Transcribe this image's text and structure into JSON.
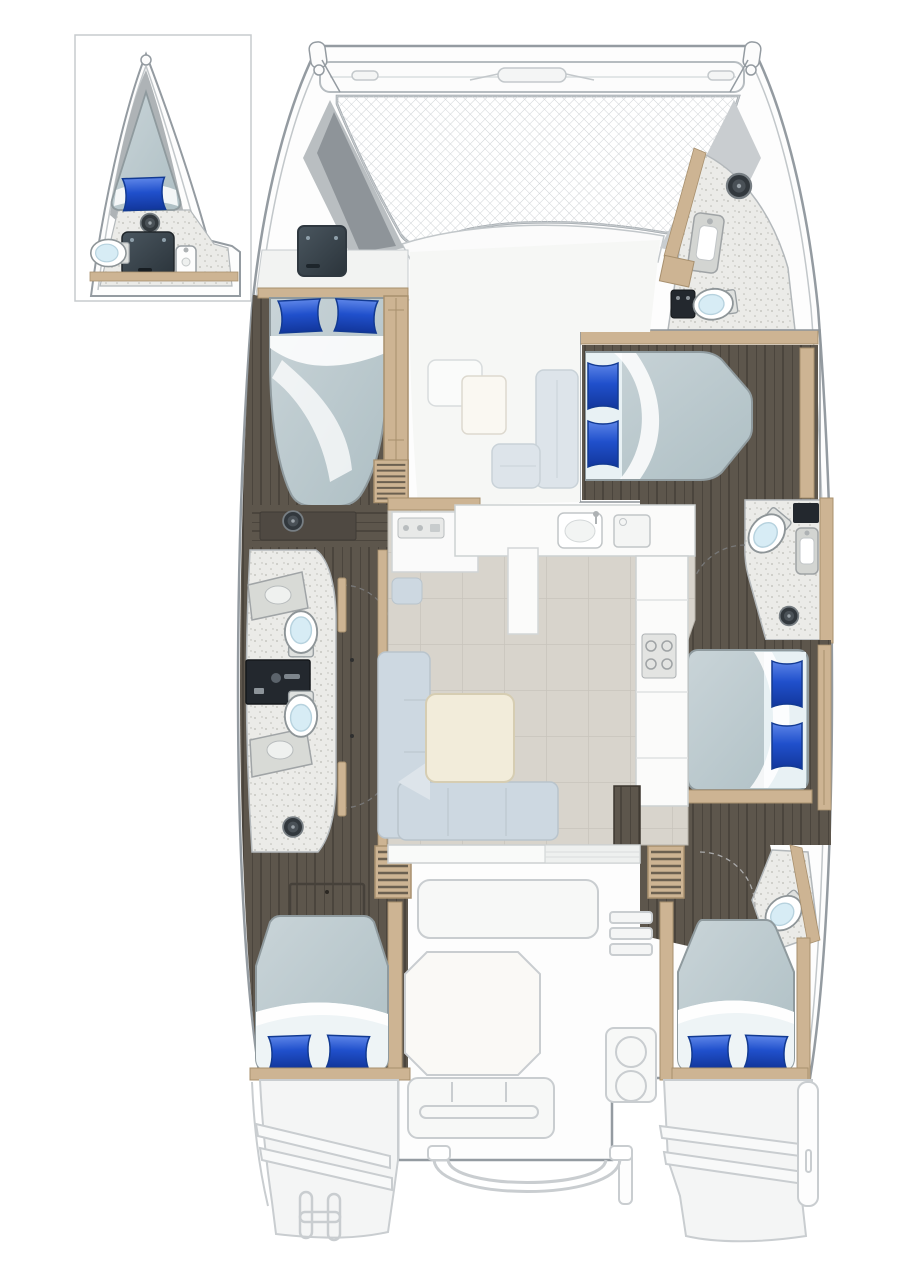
{
  "diagram": {
    "kind": "yacht-floor-plan",
    "vessel": "sailing catamaran — top-down accommodation deck plan",
    "inset_detail": {
      "location": "top-left",
      "depicts": [
        "forepeak crew berth",
        "blue pillow",
        "marine toilet",
        "wash basin",
        "deck hatch"
      ]
    },
    "port_hull": [
      "bow deck hatch",
      "forward double cabin with two blue pillows",
      "wardrobe",
      "steps",
      "bathroom with two toilets, two basins and dark vanity",
      "shower drains",
      "aft double cabin with two blue pillows",
      "companionway steps",
      "transom steps",
      "swim platform with boarding handle"
    ],
    "starboard_hull": [
      "bow head with basin and toilet",
      "deck hatch",
      "forward double berth with two blue pillows",
      "mid head with toilet, basin and shower",
      "mid double cabin with two blue pillows",
      "aft head with toilet",
      "aft double cabin with two blue pillows",
      "companionway steps",
      "transom steps",
      "swim platform with davit fitting"
    ],
    "bridgedeck": [
      "forward crossbeam",
      "trampoline net",
      "foredeck band",
      "forward lounge seats and table",
      "chart table with instrument panel",
      "galley counters with twin sinks",
      "stove with burners",
      "support column",
      "L-shaped saloon sofa",
      "square saloon table",
      "aft bulkhead with sliding-door opening"
    ],
    "aft_deck": [
      "cockpit bench",
      "octagonal cockpit table",
      "aft bench",
      "side steps",
      "grill console with two burners",
      "stern rail",
      "rail fittings"
    ],
    "counts": {
      "double_berths": 5,
      "single_berths": 1,
      "toilets": 6,
      "basins": 7,
      "deck_hatches": 4
    }
  },
  "colors": {
    "background": "#ffffff",
    "outline": "#949ba1",
    "outline_soft": "#c2c7ca",
    "ghost_stroke": "#c9cdd0",
    "ghost_fill": "#f4f5f5",
    "deck": "#fdfdfd",
    "wood": "#cdb493",
    "wood_dark": "#a8906e",
    "floor_dark": "#5d564c",
    "floor_dark_line": "#4b453d",
    "floor_saloon": "#d8d4cc",
    "floor_saloon_line": "#c8c4bc",
    "floor_bath": "#ebebe8",
    "speck": "#bcbcb5",
    "tramp_line": "#cfd3d6",
    "duvet_1": "#c9d4d8",
    "duvet_2": "#aebfc4",
    "sheet": "#ffffff",
    "pillow_1": "#5d85e8",
    "pillow_2": "#2050cc",
    "pillow_3": "#12369b",
    "pillow_edge": "#123a92",
    "hatch_1": "#4a565f",
    "hatch_2": "#2b343b",
    "panel_dark": "#23282e",
    "toilet_seat": "#d7ecf5",
    "counter": "#d8dad6",
    "counter_edge": "#a0a4a6",
    "sofa": "#cdd8e1",
    "sofa_light": "#dde4ea",
    "table": "#f2ecda",
    "table_edge": "#d6cdb2"
  }
}
